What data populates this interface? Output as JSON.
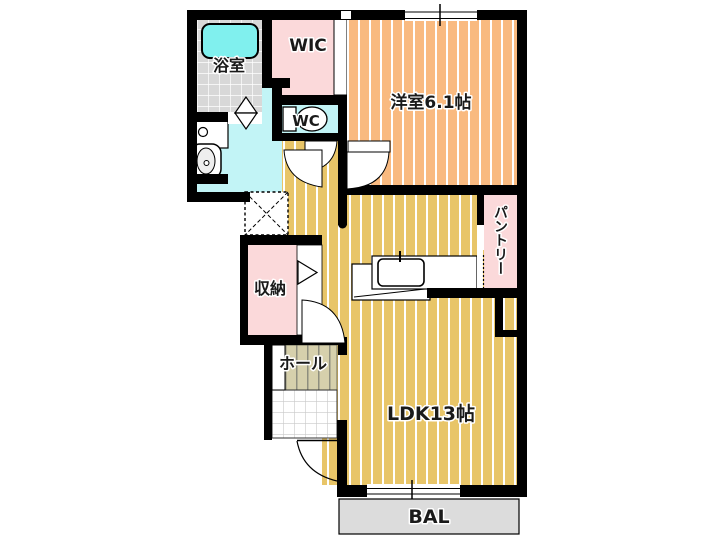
{
  "floorplan": {
    "rooms": {
      "bathroom": {
        "label": "浴室"
      },
      "wic": {
        "label": "WIC"
      },
      "toilet": {
        "label": "WC"
      },
      "western_room": {
        "label": "洋室6.1帖"
      },
      "pantry": {
        "label": "パントリー"
      },
      "storage": {
        "label": "収納"
      },
      "hall": {
        "label": "ホール"
      },
      "ldk": {
        "label": "LDK13帖"
      },
      "balcony": {
        "label": "BAL"
      }
    },
    "fixtures": [
      "bathtub",
      "toilet",
      "vanity-sink",
      "washer-pan",
      "kitchen-counter",
      "kitchen-sink",
      "fridge-space-x",
      "door-swing-arcs",
      "folding-door-triangles",
      "window-ticks"
    ],
    "colors": {
      "western_room_fill": "#f9ba80",
      "ldk_fill": "#e8c568",
      "closet_pink": "#fbd9da",
      "sanitary_cyan": "#c2f4f6",
      "bathtub_cyan": "#80f0ee",
      "bath_tile_grey": "#d8d8d8",
      "hall_khaki": "#d6d0ac",
      "balcony_grey": "#dcdcdc",
      "wall": "#000000",
      "hall_text": "#24367d",
      "ldk_text": "#1e2433"
    }
  }
}
